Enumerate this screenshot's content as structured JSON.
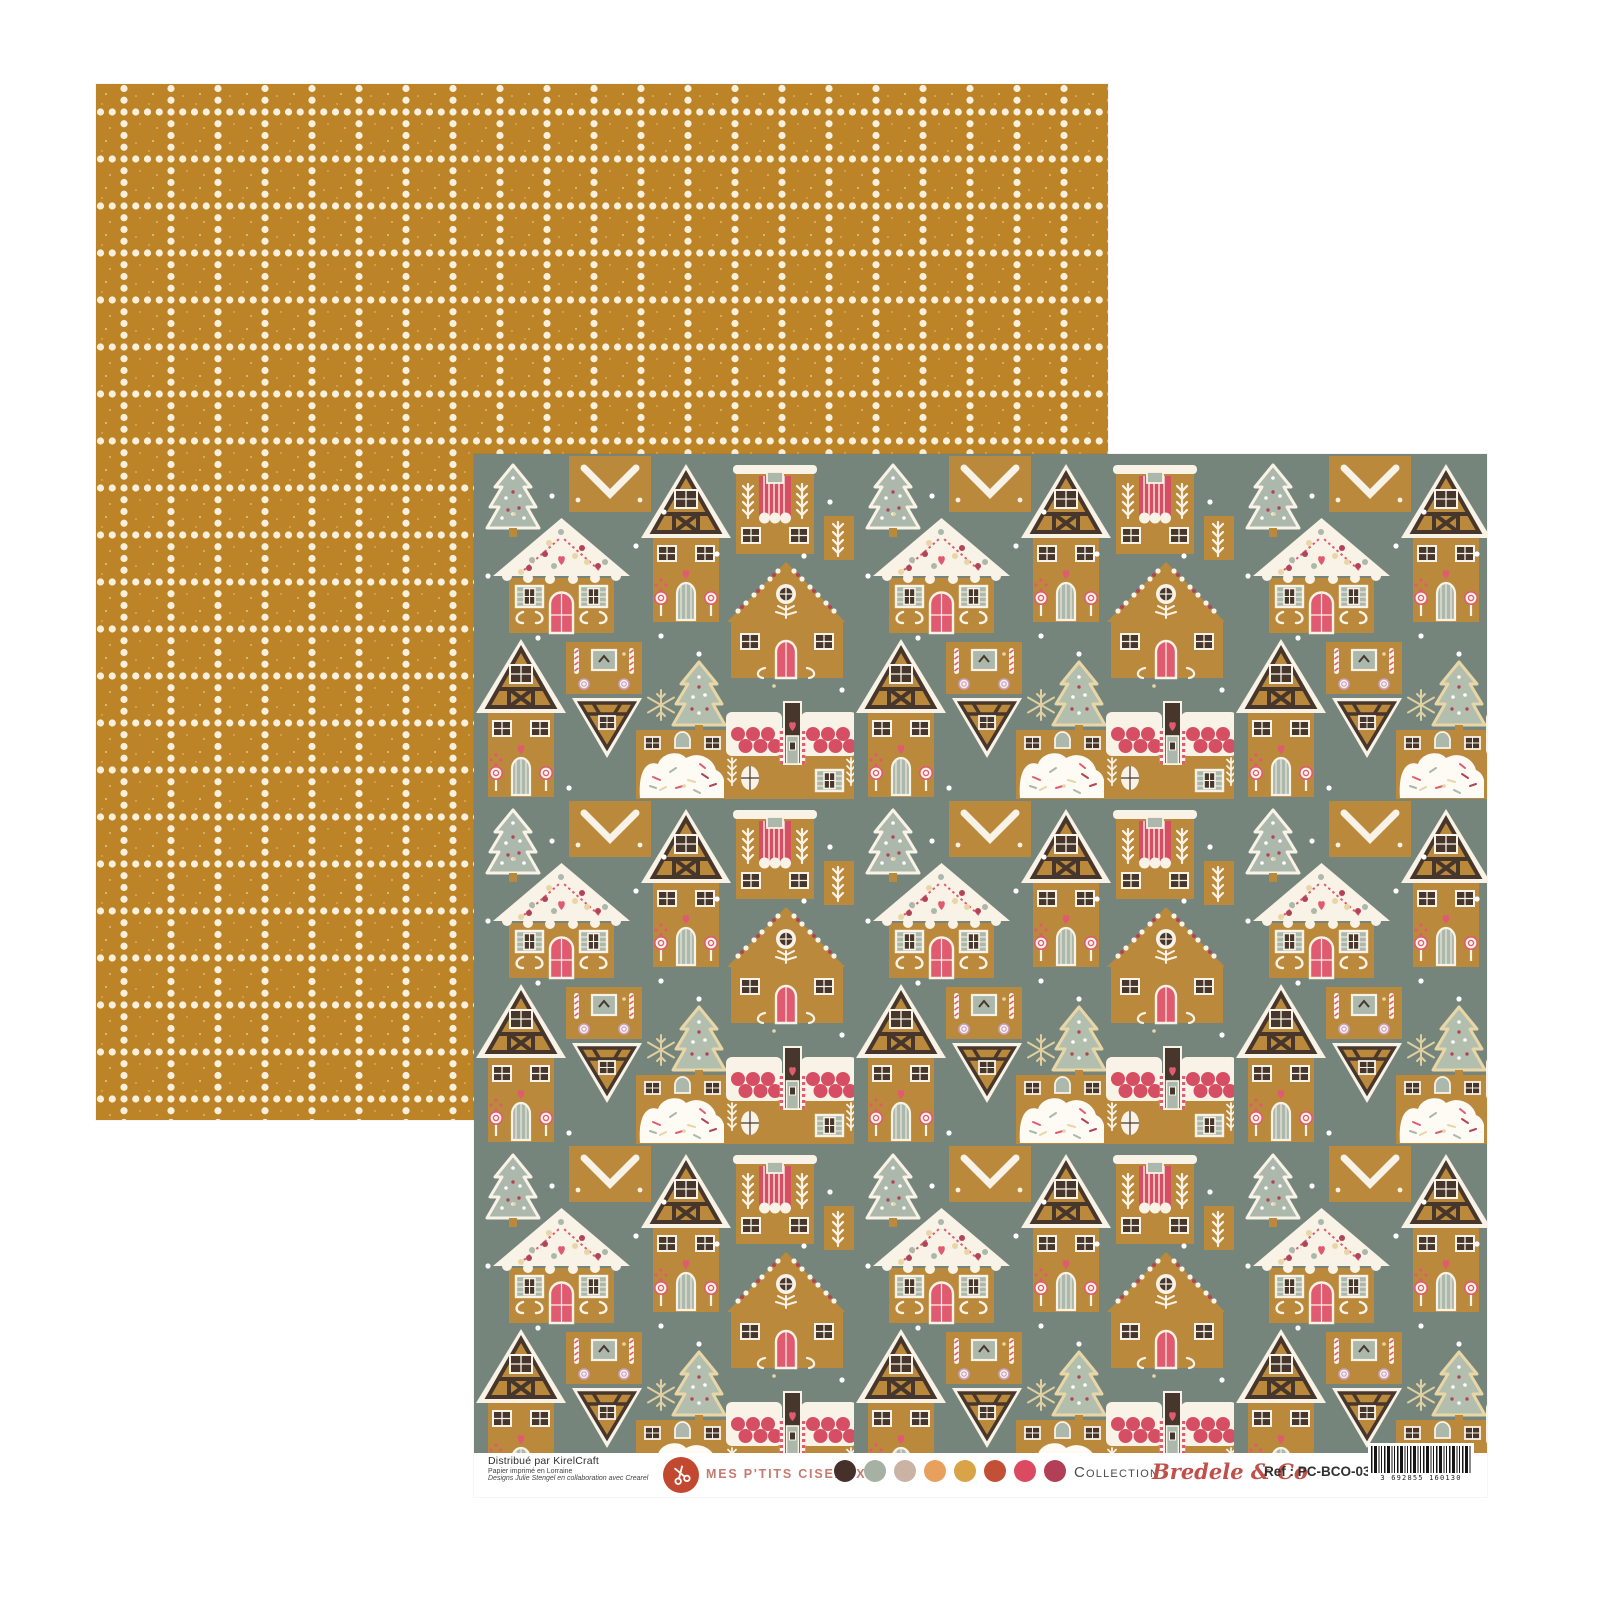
{
  "artwork": {
    "back_sheet": {
      "description": "Mustard scrapbook paper with cream dotted grid pattern",
      "bg_color": "#bc8427",
      "dot_color": "#f8f0dc"
    },
    "front_sheet": {
      "description": "Christmas gingerbread houses pattern scrapbook paper",
      "bg_color": "#76857c",
      "gingerbread_color": "#bb893c",
      "icing_color": "#f8f3e6"
    }
  },
  "footer": {
    "credits": {
      "line1": "Distribué par KirelCraft",
      "line2": "Papier imprimé en Lorraine",
      "line3": "Designs Julie Stengel en collaboration avec Crearel"
    },
    "brand": {
      "name": "MES P'TITS CISEAUX",
      "logo_icon": "scissors-icon",
      "logo_color": "#c2492f",
      "text_color": "#c57a70"
    },
    "palette": [
      "#46312a",
      "#a6b1a3",
      "#cab2a5",
      "#e8a05e",
      "#d9a348",
      "#c24f36",
      "#dc4a62",
      "#b23f55"
    ],
    "collection_label": "Collection",
    "collection_name": "Bredele & Co",
    "ref": "Ref : PC-BCO-03",
    "barcode_digits": "3 692855 160130"
  }
}
